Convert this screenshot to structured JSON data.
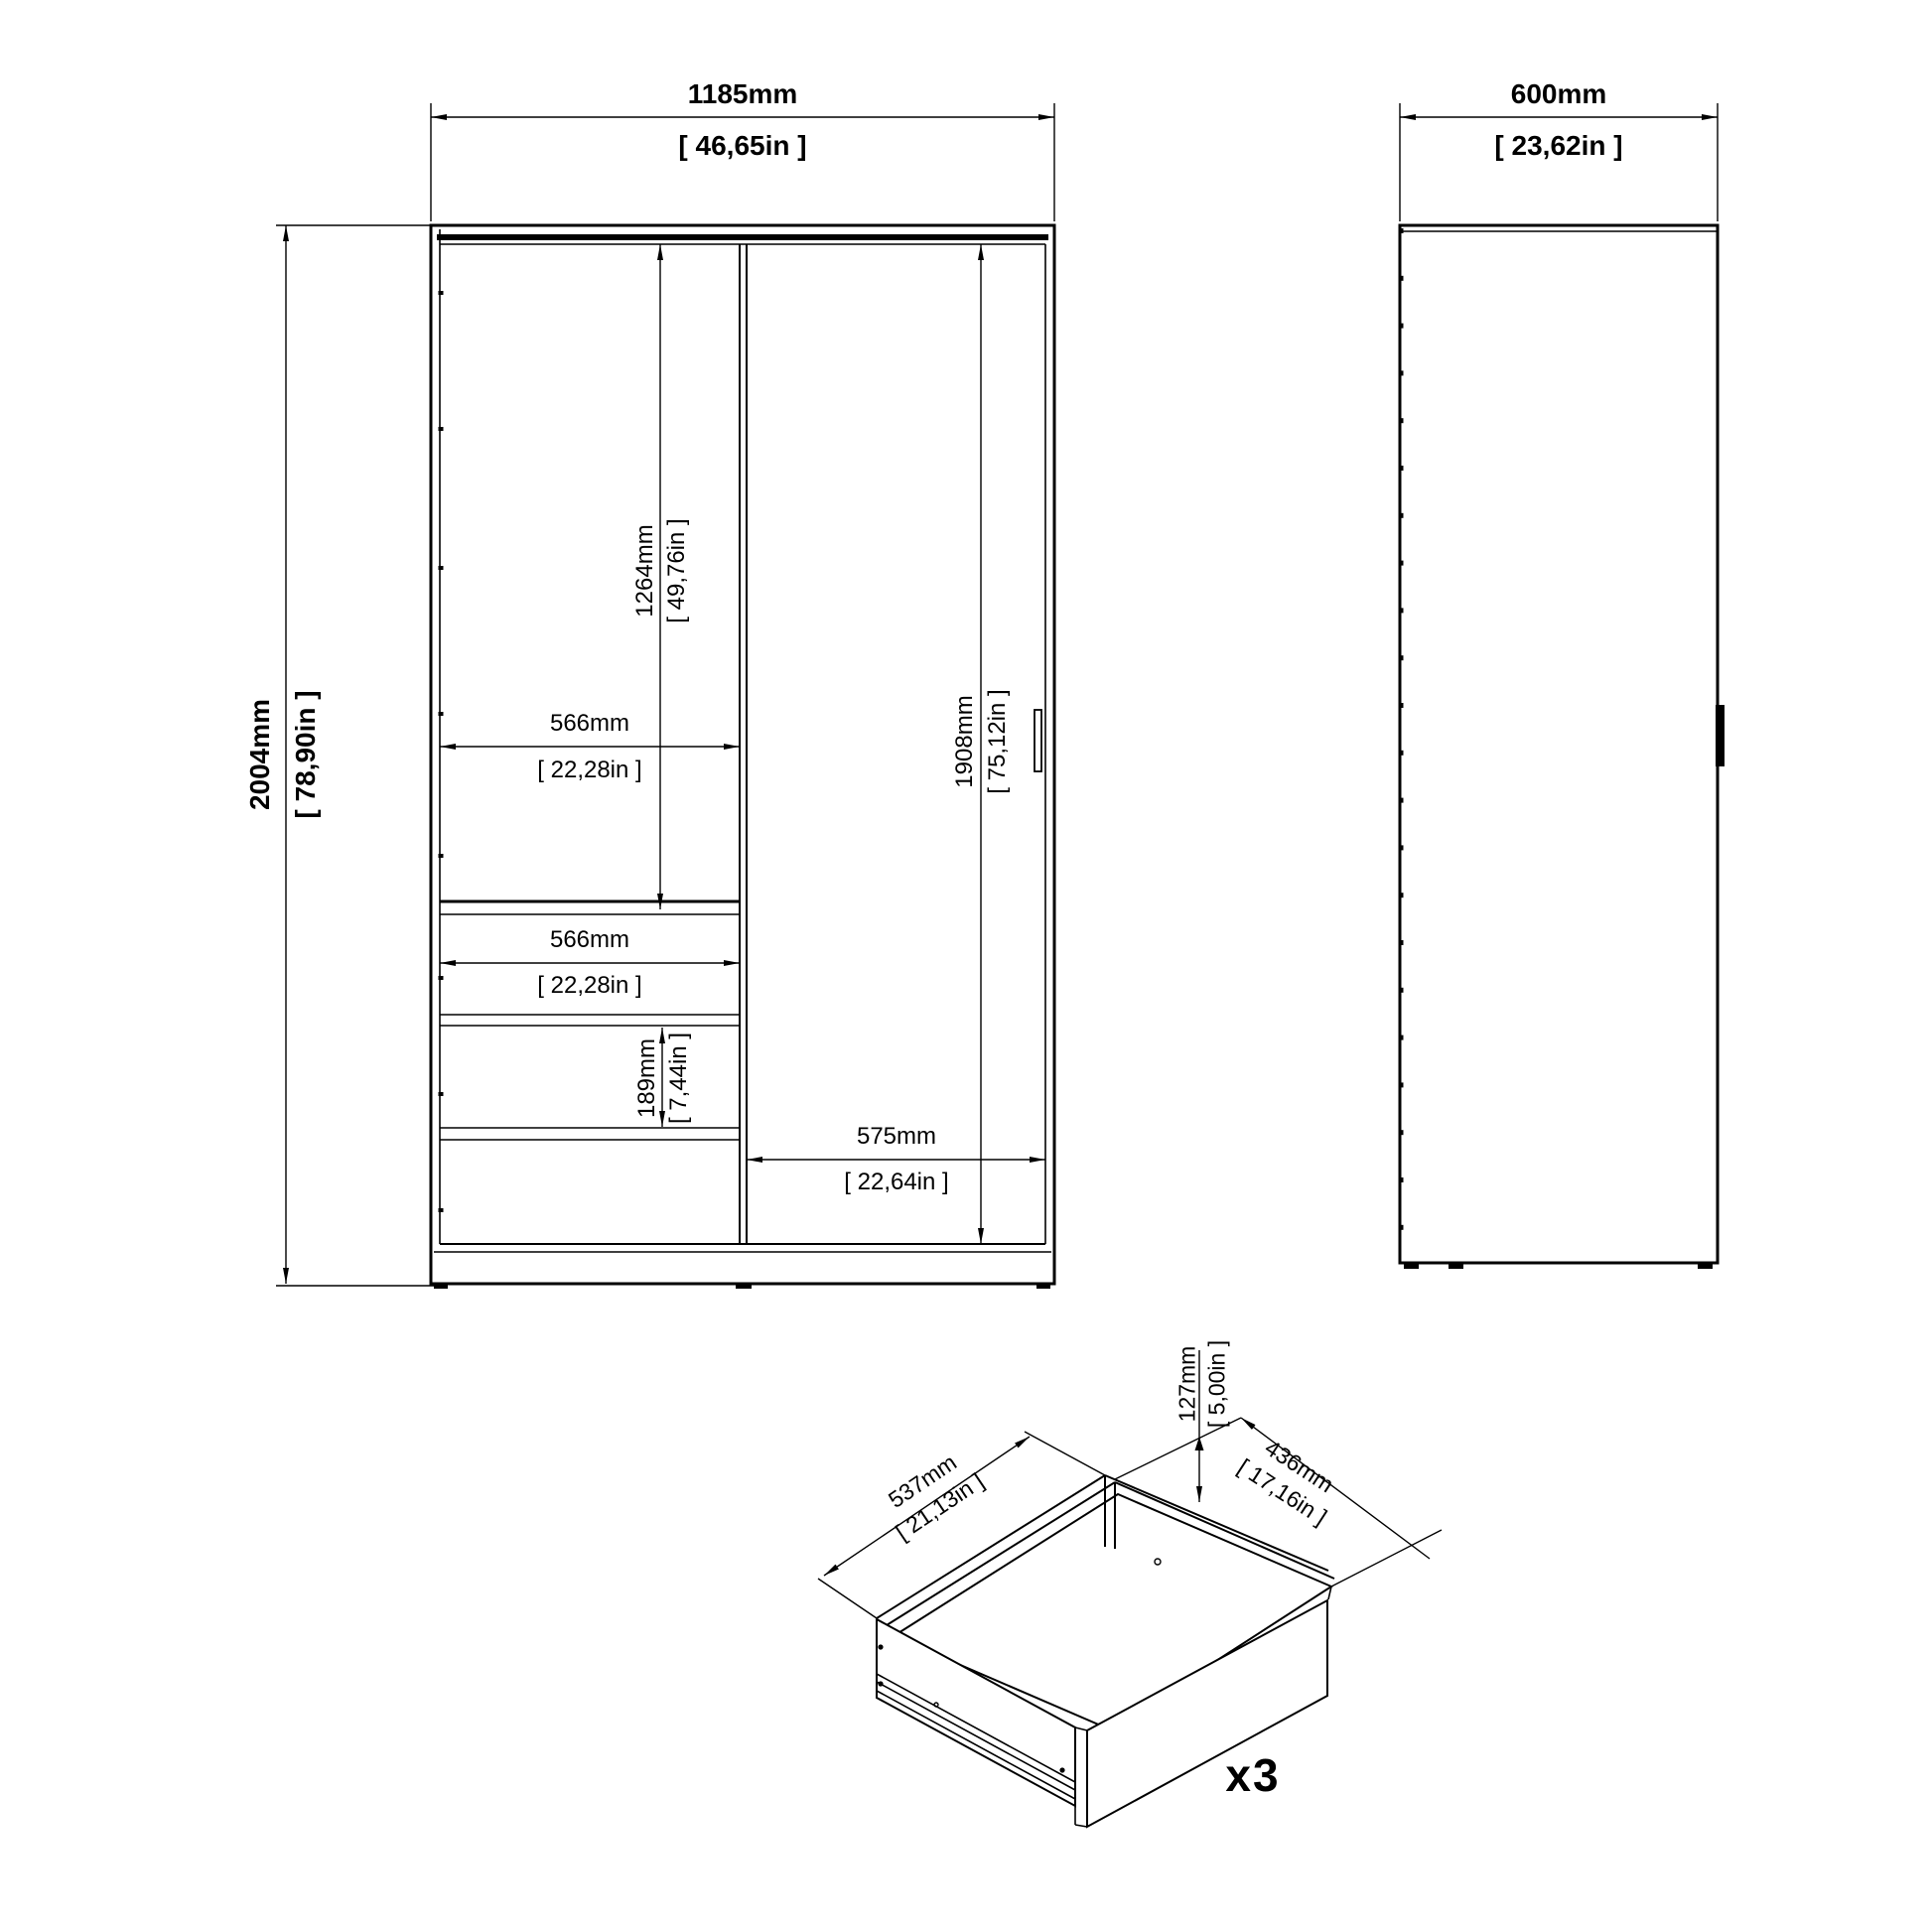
{
  "front": {
    "width_mm": "1185mm",
    "width_in": "[ 46,65in ]",
    "height_mm": "2004mm",
    "height_in": "[ 78,90in ]",
    "compartment_mm": "1264mm",
    "compartment_in": "[ 49,76in ]",
    "shelf_mm": "566mm",
    "shelf_in": "[ 22,28in ]",
    "drawer_w_mm": "566mm",
    "drawer_w_in": "[ 22,28in ]",
    "drawer_h_mm": "189mm",
    "drawer_h_in": "[ 7,44in ]",
    "door_mm": "1908mm",
    "door_in": "[ 75,12in ]",
    "door_w_mm": "575mm",
    "door_w_in": "[ 22,64in ]"
  },
  "side": {
    "depth_mm": "600mm",
    "depth_in": "[ 23,62in ]"
  },
  "drawer": {
    "width_mm": "537mm",
    "width_in": "[ 21,13in ]",
    "height_mm": "127mm",
    "height_in": "[ 5,00in ]",
    "depth_mm": "436mm",
    "depth_in": "[ 17,16in ]",
    "quantity": "x3"
  },
  "colors": {
    "line": "#000000",
    "background": "#ffffff"
  }
}
